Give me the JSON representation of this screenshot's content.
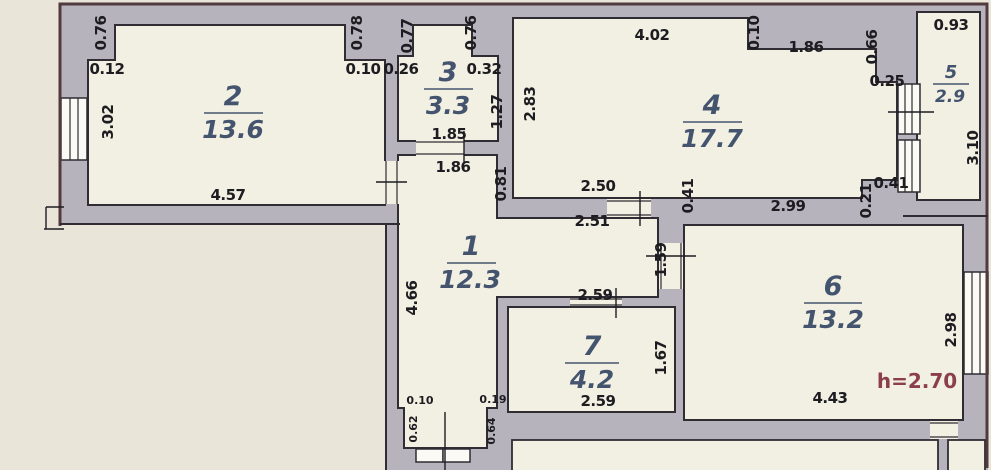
{
  "plan": {
    "type": "apartment-floor-plan",
    "height_note": "h=2.70",
    "palette": {
      "background": "#e9e6d9",
      "room_fill": "#f2f0e2",
      "wall_fill": "#b6b3bc",
      "line": "#2f2d33",
      "outer_accent": "#513a3d",
      "room_label": "#44546e",
      "dim_text": "#1d1c21",
      "height_text": "#8b4049"
    },
    "rooms": [
      {
        "number": "1",
        "area": "12.3"
      },
      {
        "number": "2",
        "area": "13.6"
      },
      {
        "number": "3",
        "area": "3.3"
      },
      {
        "number": "4",
        "area": "17.7"
      },
      {
        "number": "5",
        "area": "2.9"
      },
      {
        "number": "6",
        "area": "13.2"
      },
      {
        "number": "7",
        "area": "4.2"
      }
    ],
    "dims": [
      {
        "t": "0.76"
      },
      {
        "t": "0.12"
      },
      {
        "t": "3.02"
      },
      {
        "t": "4.57"
      },
      {
        "t": "0.78"
      },
      {
        "t": "0.10"
      },
      {
        "t": "0.77"
      },
      {
        "t": "0.26"
      },
      {
        "t": "0.76"
      },
      {
        "t": "0.32"
      },
      {
        "t": "1.27"
      },
      {
        "t": "1.85"
      },
      {
        "t": "1.86"
      },
      {
        "t": "0.81"
      },
      {
        "t": "4.02"
      },
      {
        "t": "0.10"
      },
      {
        "t": "1.86"
      },
      {
        "t": "0.66"
      },
      {
        "t": "0.25"
      },
      {
        "t": "2.83"
      },
      {
        "t": "2.50"
      },
      {
        "t": "2.51"
      },
      {
        "t": "0.41"
      },
      {
        "t": "2.99"
      },
      {
        "t": "0.21"
      },
      {
        "t": "0.41"
      },
      {
        "t": "0.93"
      },
      {
        "t": "3.10"
      },
      {
        "t": "4.66"
      },
      {
        "t": "1.59"
      },
      {
        "t": "2.59"
      },
      {
        "t": "2.59"
      },
      {
        "t": "1.67"
      },
      {
        "t": "0.10"
      },
      {
        "t": "0.19"
      },
      {
        "t": "0.62"
      },
      {
        "t": "0.64"
      },
      {
        "t": "2.98"
      },
      {
        "t": "4.43"
      },
      {
        "t": "h=2.70"
      }
    ]
  }
}
